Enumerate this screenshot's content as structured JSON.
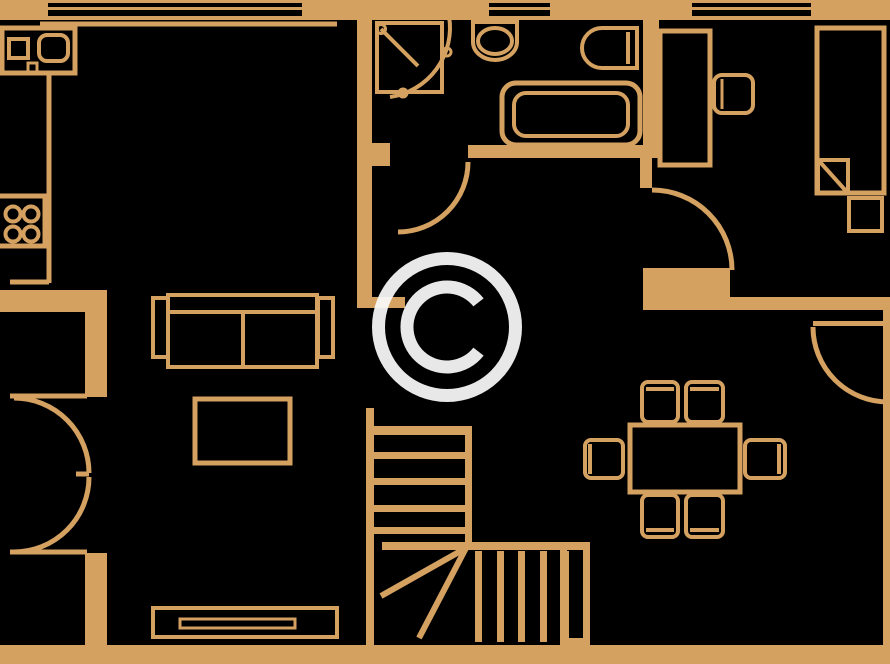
{
  "meta": {
    "type": "floor-plan",
    "canvas": {
      "width": 890,
      "height": 664
    },
    "colors": {
      "background": "#000000",
      "line": "#D4A161",
      "watermark": "#FAFAFA"
    }
  },
  "watermark": {
    "symbol": "©",
    "cx": 447,
    "cy": 327,
    "ring_r": 68.5,
    "ring_stroke": 13,
    "glyph_path": "M 478.5 351.6 A 40 40 0 1 1 478.5 302.4",
    "glyph_stroke": 13,
    "opacity": 0.93
  },
  "plan": {
    "rooms": [
      "kitchen",
      "living-room",
      "hall",
      "bathroom",
      "bedroom",
      "dining-area",
      "staircase"
    ],
    "walls": [
      {
        "id": "wall-top",
        "x": 0,
        "y": 0,
        "w": 890,
        "h": 20
      },
      {
        "id": "wall-bottom",
        "x": 0,
        "y": 645,
        "w": 890,
        "h": 19
      },
      {
        "id": "wall-right",
        "x": 883,
        "y": 310,
        "w": 7,
        "h": 335
      },
      {
        "id": "wall-kitchen-hall",
        "x": 357,
        "y": 18,
        "w": 15,
        "h": 290
      },
      {
        "id": "wall-hall-stub",
        "x": 372,
        "y": 297,
        "w": 33,
        "h": 11
      },
      {
        "id": "wall-stairwell-left",
        "x": 366,
        "y": 408,
        "w": 8,
        "h": 237
      },
      {
        "id": "wall-shower-stub",
        "x": 372,
        "y": 143,
        "w": 18,
        "h": 23
      },
      {
        "id": "wall-bathroom-bottom",
        "x": 468,
        "y": 145,
        "w": 190,
        "h": 13
      },
      {
        "id": "wall-bath-bedroom",
        "x": 643,
        "y": 18,
        "w": 16,
        "h": 140
      },
      {
        "id": "wall-bedroom-left",
        "x": 640,
        "y": 158,
        "w": 12,
        "h": 30
      },
      {
        "id": "wall-bedroom-bottom-a",
        "x": 643,
        "y": 268,
        "w": 87,
        "h": 42
      },
      {
        "id": "wall-bedroom-bottom-b",
        "x": 643,
        "y": 297,
        "w": 247,
        "h": 13
      },
      {
        "id": "wall-left-block",
        "x": 0,
        "y": 290,
        "w": 107,
        "h": 22
      },
      {
        "id": "wall-left-mid",
        "x": 85,
        "y": 312,
        "w": 22,
        "h": 85
      },
      {
        "id": "wall-left-low",
        "x": 85,
        "y": 553,
        "w": 22,
        "h": 92
      },
      {
        "id": "stair-top-bar",
        "x": 374,
        "y": 426,
        "w": 98,
        "h": 9
      },
      {
        "id": "stair-mid-bar",
        "x": 382,
        "y": 542,
        "w": 208,
        "h": 8
      },
      {
        "id": "stair-right-edge",
        "x": 465,
        "y": 426,
        "w": 7,
        "h": 122
      },
      {
        "id": "chimney-outer",
        "x": 560,
        "y": 543,
        "w": 30,
        "h": 102
      },
      {
        "id": "door-panel-bottom-right",
        "x": 813,
        "y": 321,
        "w": 72,
        "h": 5
      }
    ],
    "holes": [
      {
        "id": "window-kitchen-slit-1",
        "x": 48,
        "y": 3,
        "w": 254,
        "h": 4
      },
      {
        "id": "window-kitchen-slit-2",
        "x": 48,
        "y": 10,
        "w": 254,
        "h": 6
      },
      {
        "id": "window-bathroom-slit-1",
        "x": 489,
        "y": 3,
        "w": 61,
        "h": 4
      },
      {
        "id": "window-bathroom-slit-2",
        "x": 489,
        "y": 10,
        "w": 61,
        "h": 6
      },
      {
        "id": "window-bedroom-slit-1",
        "x": 692,
        "y": 3,
        "w": 119,
        "h": 4
      },
      {
        "id": "window-bedroom-slit-2",
        "x": 692,
        "y": 10,
        "w": 119,
        "h": 6
      },
      {
        "id": "chimney-inner",
        "x": 567,
        "y": 550,
        "w": 16,
        "h": 88
      }
    ],
    "treads": [
      {
        "id": "stair-tread-h1",
        "x": 374,
        "y": 452,
        "w": 91,
        "h": 7
      },
      {
        "id": "stair-tread-h2",
        "x": 374,
        "y": 478,
        "w": 91,
        "h": 7
      },
      {
        "id": "stair-tread-h3",
        "x": 374,
        "y": 505,
        "w": 91,
        "h": 7
      },
      {
        "id": "stair-tread-h4",
        "x": 374,
        "y": 527,
        "w": 91,
        "h": 7
      },
      {
        "id": "stair-tread-v1",
        "x": 475,
        "y": 551,
        "w": 7,
        "h": 91
      },
      {
        "id": "stair-tread-v2",
        "x": 497,
        "y": 551,
        "w": 7,
        "h": 91
      },
      {
        "id": "stair-tread-v3",
        "x": 518,
        "y": 551,
        "w": 7,
        "h": 91
      },
      {
        "id": "stair-tread-v4",
        "x": 540,
        "y": 551,
        "w": 7,
        "h": 91
      },
      {
        "id": "stair-tread-v5",
        "x": 562,
        "y": 551,
        "w": 7,
        "h": 91
      }
    ],
    "outlines": [
      {
        "id": "kitchen-sink-counter",
        "x": 2,
        "y": 28,
        "w": 73,
        "h": 45,
        "sw": 5,
        "rx": 0
      },
      {
        "id": "kitchen-sink-basin",
        "x": 9,
        "y": 39,
        "w": 19,
        "h": 19,
        "sw": 4,
        "rx": 0
      },
      {
        "id": "kitchen-sink-bowl",
        "x": 39,
        "y": 35,
        "w": 29,
        "h": 26,
        "sw": 4,
        "rx": 8
      },
      {
        "id": "kitchen-sink-tap",
        "x": 28,
        "y": 63,
        "w": 9,
        "h": 9,
        "sw": 3,
        "rx": 0
      },
      {
        "id": "kitchen-stove",
        "x": -3,
        "y": 196,
        "w": 48,
        "h": 50,
        "sw": 5,
        "rx": 0
      },
      {
        "id": "shower-tray",
        "x": 377,
        "y": 23,
        "w": 65,
        "h": 69,
        "sw": 4,
        "rx": 0
      },
      {
        "id": "bathtub-outer",
        "x": 502,
        "y": 83,
        "w": 138,
        "h": 62,
        "sw": 5,
        "rx": 14
      },
      {
        "id": "bathtub-inner",
        "x": 514,
        "y": 93,
        "w": 114,
        "h": 43,
        "sw": 4,
        "rx": 12
      },
      {
        "id": "sofa-back",
        "x": 168,
        "y": 295,
        "w": 149,
        "h": 17,
        "sw": 4,
        "rx": 0
      },
      {
        "id": "sofa-seat",
        "x": 168,
        "y": 312,
        "w": 149,
        "h": 55,
        "sw": 4,
        "rx": 0
      },
      {
        "id": "sofa-armrest-left",
        "x": 153,
        "y": 298,
        "w": 15,
        "h": 59,
        "sw": 4,
        "rx": 0
      },
      {
        "id": "sofa-armrest-right",
        "x": 318,
        "y": 298,
        "w": 15,
        "h": 59,
        "sw": 4,
        "rx": 0
      },
      {
        "id": "coffee-table",
        "x": 195,
        "y": 399,
        "w": 95,
        "h": 64,
        "sw": 5,
        "rx": 0
      },
      {
        "id": "tv-unit",
        "x": 153,
        "y": 608,
        "w": 184,
        "h": 29,
        "sw": 4,
        "rx": 0
      },
      {
        "id": "tv-screen",
        "x": 180,
        "y": 619,
        "w": 115,
        "h": 9,
        "sw": 3,
        "rx": 0
      },
      {
        "id": "desk",
        "x": 660,
        "y": 31,
        "w": 50,
        "h": 134,
        "sw": 5,
        "rx": 0
      },
      {
        "id": "desk-chair",
        "x": 714,
        "y": 75,
        "w": 39,
        "h": 38,
        "sw": 4,
        "rx": 8
      },
      {
        "id": "bed",
        "x": 817,
        "y": 28,
        "w": 67,
        "h": 165,
        "sw": 5,
        "rx": 0
      },
      {
        "id": "bed-fold-corner",
        "x": 818,
        "y": 160,
        "w": 30,
        "h": 33,
        "sw": 4,
        "rx": 0
      },
      {
        "id": "nightstand",
        "x": 849,
        "y": 198,
        "w": 33,
        "h": 33,
        "sw": 4,
        "rx": 0
      },
      {
        "id": "dining-table",
        "x": 630,
        "y": 425,
        "w": 110,
        "h": 67,
        "sw": 5,
        "rx": 0
      },
      {
        "id": "dining-chair-top-1",
        "x": 642,
        "y": 382,
        "w": 36,
        "h": 40,
        "sw": 4,
        "rx": 6
      },
      {
        "id": "dining-chair-top-2",
        "x": 686,
        "y": 382,
        "w": 37,
        "h": 40,
        "sw": 4,
        "rx": 6
      },
      {
        "id": "dining-chair-left",
        "x": 585,
        "y": 440,
        "w": 38,
        "h": 38,
        "sw": 4,
        "rx": 6
      },
      {
        "id": "dining-chair-right",
        "x": 745,
        "y": 440,
        "w": 40,
        "h": 38,
        "sw": 4,
        "rx": 6
      },
      {
        "id": "dining-chair-bottom-1",
        "x": 642,
        "y": 495,
        "w": 36,
        "h": 42,
        "sw": 4,
        "rx": 6
      },
      {
        "id": "dining-chair-bottom-2",
        "x": 686,
        "y": 495,
        "w": 37,
        "h": 42,
        "sw": 4,
        "rx": 6
      }
    ],
    "circles": [
      {
        "id": "stove-burner-1",
        "cx": 13,
        "cy": 214,
        "r": 7.5,
        "sw": 4,
        "fill": "none"
      },
      {
        "id": "stove-burner-2",
        "cx": 31,
        "cy": 214,
        "r": 7.5,
        "sw": 4,
        "fill": "none"
      },
      {
        "id": "stove-burner-3",
        "cx": 13,
        "cy": 234,
        "r": 7.5,
        "sw": 4,
        "fill": "none"
      },
      {
        "id": "stove-burner-4",
        "cx": 31,
        "cy": 234,
        "r": 7.5,
        "sw": 4,
        "fill": "none"
      },
      {
        "id": "shower-hinge-dot",
        "cx": 381,
        "cy": 29,
        "r": 4.5,
        "sw": 3,
        "fill": "none"
      },
      {
        "id": "shower-arc-dot-1",
        "cx": 447,
        "cy": 52,
        "r": 4,
        "sw": 3,
        "fill": "none"
      },
      {
        "id": "shower-arc-dot-2",
        "cx": 403,
        "cy": 93,
        "r": 4,
        "sw": 3,
        "fill": "none"
      }
    ],
    "ellipses": [
      {
        "id": "toilet-bowl",
        "cx": 495,
        "cy": 41,
        "rx": 17,
        "ry": 13,
        "sw": 4
      }
    ],
    "lines": [
      {
        "id": "counter-top-edge",
        "x1": 40,
        "y1": 24,
        "x2": 337,
        "y2": 24,
        "sw": 5
      },
      {
        "id": "counter-side-edge",
        "x1": 49,
        "y1": 73,
        "x2": 49,
        "y2": 283,
        "sw": 5
      },
      {
        "id": "counter-corner-dash",
        "x1": 10,
        "y1": 282,
        "x2": 49,
        "y2": 282,
        "sw": 5
      },
      {
        "id": "french-door-jamb-top",
        "x1": 10,
        "y1": 396,
        "x2": 87,
        "y2": 396,
        "sw": 5
      },
      {
        "id": "french-door-jamb-bottom",
        "x1": 10,
        "y1": 552,
        "x2": 87,
        "y2": 552,
        "sw": 5
      },
      {
        "id": "french-door-meeting-dash",
        "x1": 76,
        "y1": 474,
        "x2": 89,
        "y2": 474,
        "sw": 5
      },
      {
        "id": "shower-door-panel",
        "x1": 381,
        "y1": 29,
        "x2": 418,
        "y2": 66,
        "sw": 4
      },
      {
        "id": "stair-winder-tread-1",
        "x1": 466,
        "y1": 548,
        "x2": 381,
        "y2": 596,
        "sw": 6
      },
      {
        "id": "stair-winder-tread-2",
        "x1": 466,
        "y1": 548,
        "x2": 419,
        "y2": 638,
        "sw": 6
      },
      {
        "id": "bed-fold-diagonal",
        "x1": 820,
        "y1": 162,
        "x2": 846,
        "y2": 191,
        "sw": 4
      },
      {
        "id": "sofa-seat-divider",
        "x1": 243,
        "y1": 312,
        "x2": 243,
        "y2": 367,
        "sw": 4
      },
      {
        "id": "basin-front-edge",
        "x1": 628,
        "y1": 32,
        "x2": 628,
        "y2": 64,
        "sw": 4
      },
      {
        "id": "desk-chair-backrest",
        "x1": 722,
        "y1": 79,
        "x2": 722,
        "y2": 109,
        "sw": 3
      },
      {
        "id": "chair-top-1-backrest",
        "x1": 646,
        "y1": 389,
        "x2": 674,
        "y2": 389,
        "sw": 4
      },
      {
        "id": "chair-top-2-backrest",
        "x1": 690,
        "y1": 389,
        "x2": 719,
        "y2": 389,
        "sw": 4
      },
      {
        "id": "chair-left-backrest",
        "x1": 590,
        "y1": 444,
        "x2": 590,
        "y2": 474,
        "sw": 4
      },
      {
        "id": "chair-right-backrest",
        "x1": 779,
        "y1": 444,
        "x2": 779,
        "y2": 474,
        "sw": 4
      },
      {
        "id": "chair-bottom-1-backrest",
        "x1": 646,
        "y1": 530,
        "x2": 674,
        "y2": 530,
        "sw": 4
      },
      {
        "id": "chair-bottom-2-backrest",
        "x1": 690,
        "y1": 530,
        "x2": 719,
        "y2": 530,
        "sw": 4
      }
    ],
    "paths": [
      {
        "id": "toilet-body",
        "d": "M 473 22 L 517 22 L 517 42 A 22 18 0 0 1 473 42 Z",
        "sw": 4
      },
      {
        "id": "wash-basin",
        "d": "M 637 28 L 602 28 A 20 20 0 0 0 602 68 L 637 68 Z",
        "sw": 4
      },
      {
        "id": "french-door-arc-top",
        "d": "M 14 398 A 75 75 0 0 1 89 473",
        "sw": 5
      },
      {
        "id": "french-door-arc-bottom",
        "d": "M 89 477 A 75 75 0 0 1 14 552",
        "sw": 5
      },
      {
        "id": "bathroom-door-arc",
        "d": "M 468 162 A 70 70 0 0 1 398 232",
        "sw": 5
      },
      {
        "id": "bedroom-door-arc",
        "d": "M 652 190 A 80 80 0 0 1 732 270",
        "sw": 5
      },
      {
        "id": "bottom-right-door-arc",
        "d": "M 813 327 A 75 75 0 0 0 888 402",
        "sw": 5
      },
      {
        "id": "shower-door-arc",
        "d": "M 449 16 A 70 70 0 0 1 390 97",
        "sw": 4
      }
    ]
  }
}
